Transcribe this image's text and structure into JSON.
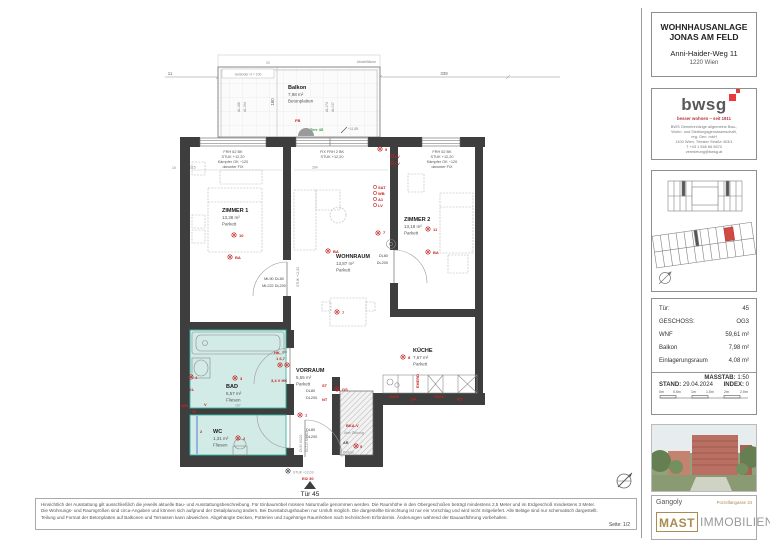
{
  "titleblock": {
    "line1": "WOHNHAUSANLAGE",
    "line2": "JONAS AM FELD",
    "address": "Anni-Haider-Weg 11",
    "city": "1220 Wien"
  },
  "bwsg": {
    "logo": "bwsg",
    "tagline": "besser wohnen – seit 1911",
    "org1": "BWS Gemeinnützige allgemeine Bau-,",
    "org2": "Wohn- und Siedlungsgenossenschaft,",
    "org3": "reg. Gen. mbH",
    "org4": "1100 Wien, Triester Straße 403/1",
    "org5": "T +43 1 546 66 5670",
    "org6": "vermietung@bwsg.at"
  },
  "info_table": {
    "rows": [
      {
        "label": "Tür:",
        "value": "45"
      },
      {
        "label": "GESCHOSS:",
        "value": "OG3"
      },
      {
        "label": "WNF",
        "value": "59,61 m²"
      },
      {
        "label": "Balkon",
        "value": "7,98 m²"
      },
      {
        "label": "Einlagerungsraum",
        "value": "4,08 m²"
      }
    ],
    "massstab_label": "MASSTAB:",
    "massstab": "1:50",
    "stand_label": "STAND:",
    "stand": "29.04.2024",
    "index_label": "INDEX:",
    "index": "0",
    "scale_ticks": [
      "0m",
      "0.5m",
      "1m",
      "1.5m",
      "2m",
      "2.5m"
    ]
  },
  "branding": {
    "architect": "Gangoly",
    "street": "Porzellangasse 34",
    "mast": "MAST",
    "immobilien": "IMMOBILIEN"
  },
  "footer": {
    "line1": "Hinsichtlich der Ausstattung gilt ausschließlich die jeweils aktuelle Bau- und Ausstattungsbeschreibung. Für Einbaumöbel müssen Naturmaße genommen werden. Die Raumhöhe in den Obergeschoßen beträgt mindestens 2,5 Meter und im Erdgeschoß mindestens 3 Meter.",
    "line2": "Die Wohnungs- und Raumgrößen sind circa-Angaben und können sich aufgrund der Detailplanung ändern. Bei Dunstabzugshauben nur Umluft möglich. Die dargestellte Einrichtung ist nur ein Vorschlag und wird nicht mitgeliefert. Alle Beläge sind nur schematisch dargestellt.",
    "line3": "Teilung und Format der Betonplatten auf Balkonen und Terrassen kann abweichen. Abgehängte Decken, Potterien und zugehörige Raumhöhen nach technischem Erfordernis. Änderungen während der Bauausführung vorbehalten.",
    "page": "Seite: 1/2"
  },
  "plan": {
    "dims": {
      "d11": "11",
      "d430": "430",
      "d339": "339",
      "d180": "180",
      "d20": "20",
      "d15": "15",
      "d215": "215",
      "d264": "264",
      "d167": "167"
    },
    "balcony": {
      "name": "Balkon",
      "area": "7,98 m²",
      "floor": "Betonplatten",
      "railing": "Geländer H = 100",
      "abstell": "Abstellfläche",
      "level": "+11,85",
      "terr_door": "Terr 45",
      "fb": "FB"
    },
    "win_left": [
      "FRH 62 BK",
      "STUK +12,20",
      "Kämpfer OK ~120",
      "darunter FIX"
    ],
    "win_mid": [
      "FIX  FRH 2  BK",
      "STUK +12,20"
    ],
    "win_right": [
      "FRH 62 BK",
      "STUK +12,20",
      "Kämpfer OK ~120",
      "darunter FIX"
    ],
    "rooms": {
      "zimmer1": {
        "name": "ZIMMER 1",
        "area": "13,38 m²",
        "floor": "Parkett"
      },
      "wohnraum": {
        "name": "WOHNRAUM",
        "area": "13,87 m²",
        "floor": "Parkett"
      },
      "zimmer2": {
        "name": "ZIMMER 2",
        "area": "13,18 m²",
        "floor": "Parkett"
      },
      "kueche": {
        "name": "KÜCHE",
        "area": "7,67 m²",
        "floor": "Parkett"
      },
      "bad": {
        "name": "BAD",
        "area": "5,57 m²",
        "floor": "Fliesen"
      },
      "wc": {
        "name": "WC",
        "area": "1,31 m²",
        "floor": "Fliesen"
      },
      "vorraum": {
        "name": "VORRAUM",
        "area": "5,55 m²",
        "floor": "Parkett"
      }
    },
    "doors": {
      "z1_l1": "ML90  DL80",
      "z1_l2": "ML222  DL200",
      "dl80": "DL80",
      "dl200": "DL200",
      "ent_v1": "DL90 M222",
      "ent_v2": "DL210 ML263",
      "stuk1192": "STUK +11,92"
    },
    "entrance": {
      "stuk": "STUK +12,03",
      "ei": "EI2 30",
      "tuer": "Tür 45"
    },
    "red": {
      "lv": "LV",
      "ba": "BA",
      "sat": "SAT",
      "wb": "WB",
      "a1": "A1",
      "hk": "HK",
      "kl": "KL",
      "wm": "WM",
      "tr": "TR",
      "st": "ST",
      "nt": "NT",
      "gs": "GS",
      "bkav": "BKA-V",
      "eherd": "EHERD",
      "h105": "H105",
      "da": "DA",
      "ks": "KS",
      "v": "V",
      "n1": "1",
      "n2": "2",
      "n3": "3",
      "n4": "4",
      "n5": "5",
      "n167": "1  6,7",
      "n34vhk": "3,4 V  HK",
      "n7": "7",
      "n8": "8",
      "n9": "9",
      "n10": "10",
      "n11": "11"
    },
    "shaft": {
      "ar": "AR",
      "podest": "Podest",
      "ueber": "über Öffnung"
    },
    "codes": {
      "al1": "AL188",
      "al2": "AL194",
      "al3": "AL174",
      "al4": "AL037"
    }
  }
}
